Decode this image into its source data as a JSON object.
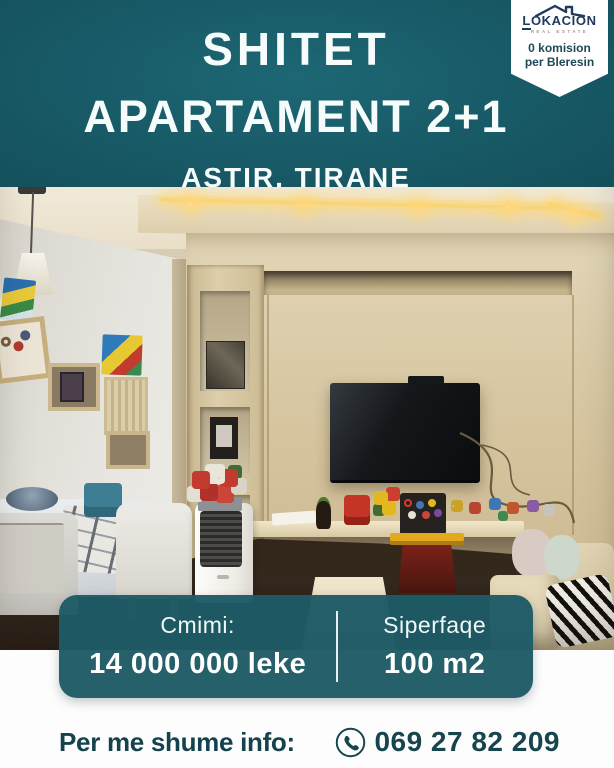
{
  "header": {
    "title_line1": "SHITET",
    "title_line2": "APARTAMENT 2+1",
    "location": "ASTIR, TIRANE"
  },
  "badge": {
    "brand": "LOKACION",
    "brand_subtitle": "REAL ESTATE",
    "offer_line1": "0 komision",
    "offer_line2": "per Bleresin"
  },
  "listing": {
    "price_label": "Cmimi:",
    "price_value": "14 000 000 leke",
    "area_label": "Siperfaqe",
    "area_value": "100 m2"
  },
  "contact": {
    "label": "Per me shume info:",
    "phone_number": "069 27 82 209"
  },
  "photo": {
    "alt": "Living room: beige TV wall with display niches and warm LED cove lighting, wall-mounted TV with trailing cable, floating shelf scattered with children's toys and a toy workbench, white portable air cooler topped with a red and white rose bouquet, dining table with plaid throw and white slip-covered chairs, pendant cone lamp, beige armchairs and poufs with a zebra-print blanket"
  },
  "colors": {
    "teal_gradient_center": "#1d6774",
    "teal_gradient_edge": "#0e3d48",
    "card_teal": "#1e5b66",
    "dark_teal_text": "#14434d",
    "led_gold": "#f9d577",
    "white": "#ffffff"
  }
}
